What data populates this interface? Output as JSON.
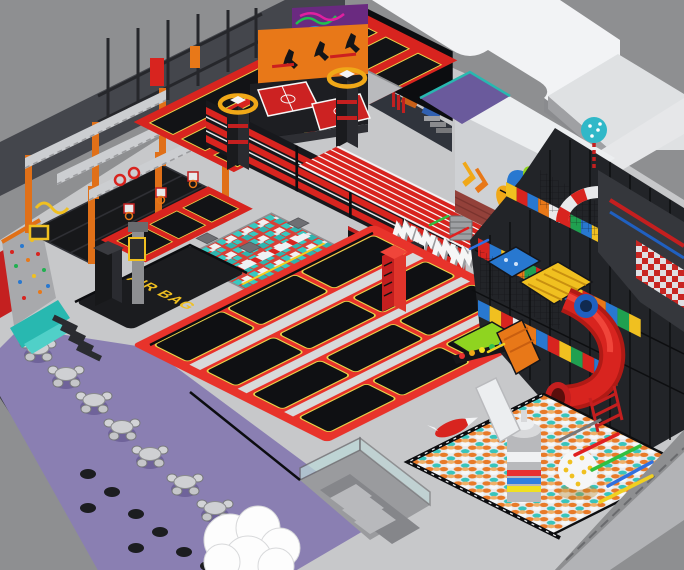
{
  "scene": {
    "description": "Isometric 3D render of an indoor trampoline park and soft-play center",
    "signs": {
      "squad_line1": "SQUAD",
      "squad_line2": "UP",
      "airbag": "AIR BAG"
    },
    "colors": {
      "background": "#8e8f91",
      "floor": "#c7c8ca",
      "court_red": "#e8332b",
      "track_red": "#d8241f",
      "bed_black": "#101114",
      "piping_yellow": "#e8d44a",
      "foam_teal": "#38c8c0",
      "orange_wall": "#e87818",
      "purple_floor": "#8a7fb2",
      "gold_ring": "#f0a818",
      "airbag_text": "#f0c020",
      "ball_orange": "#e87a28",
      "roof_white": "#f2f3f5",
      "wall_charcoal": "#44464c"
    }
  }
}
